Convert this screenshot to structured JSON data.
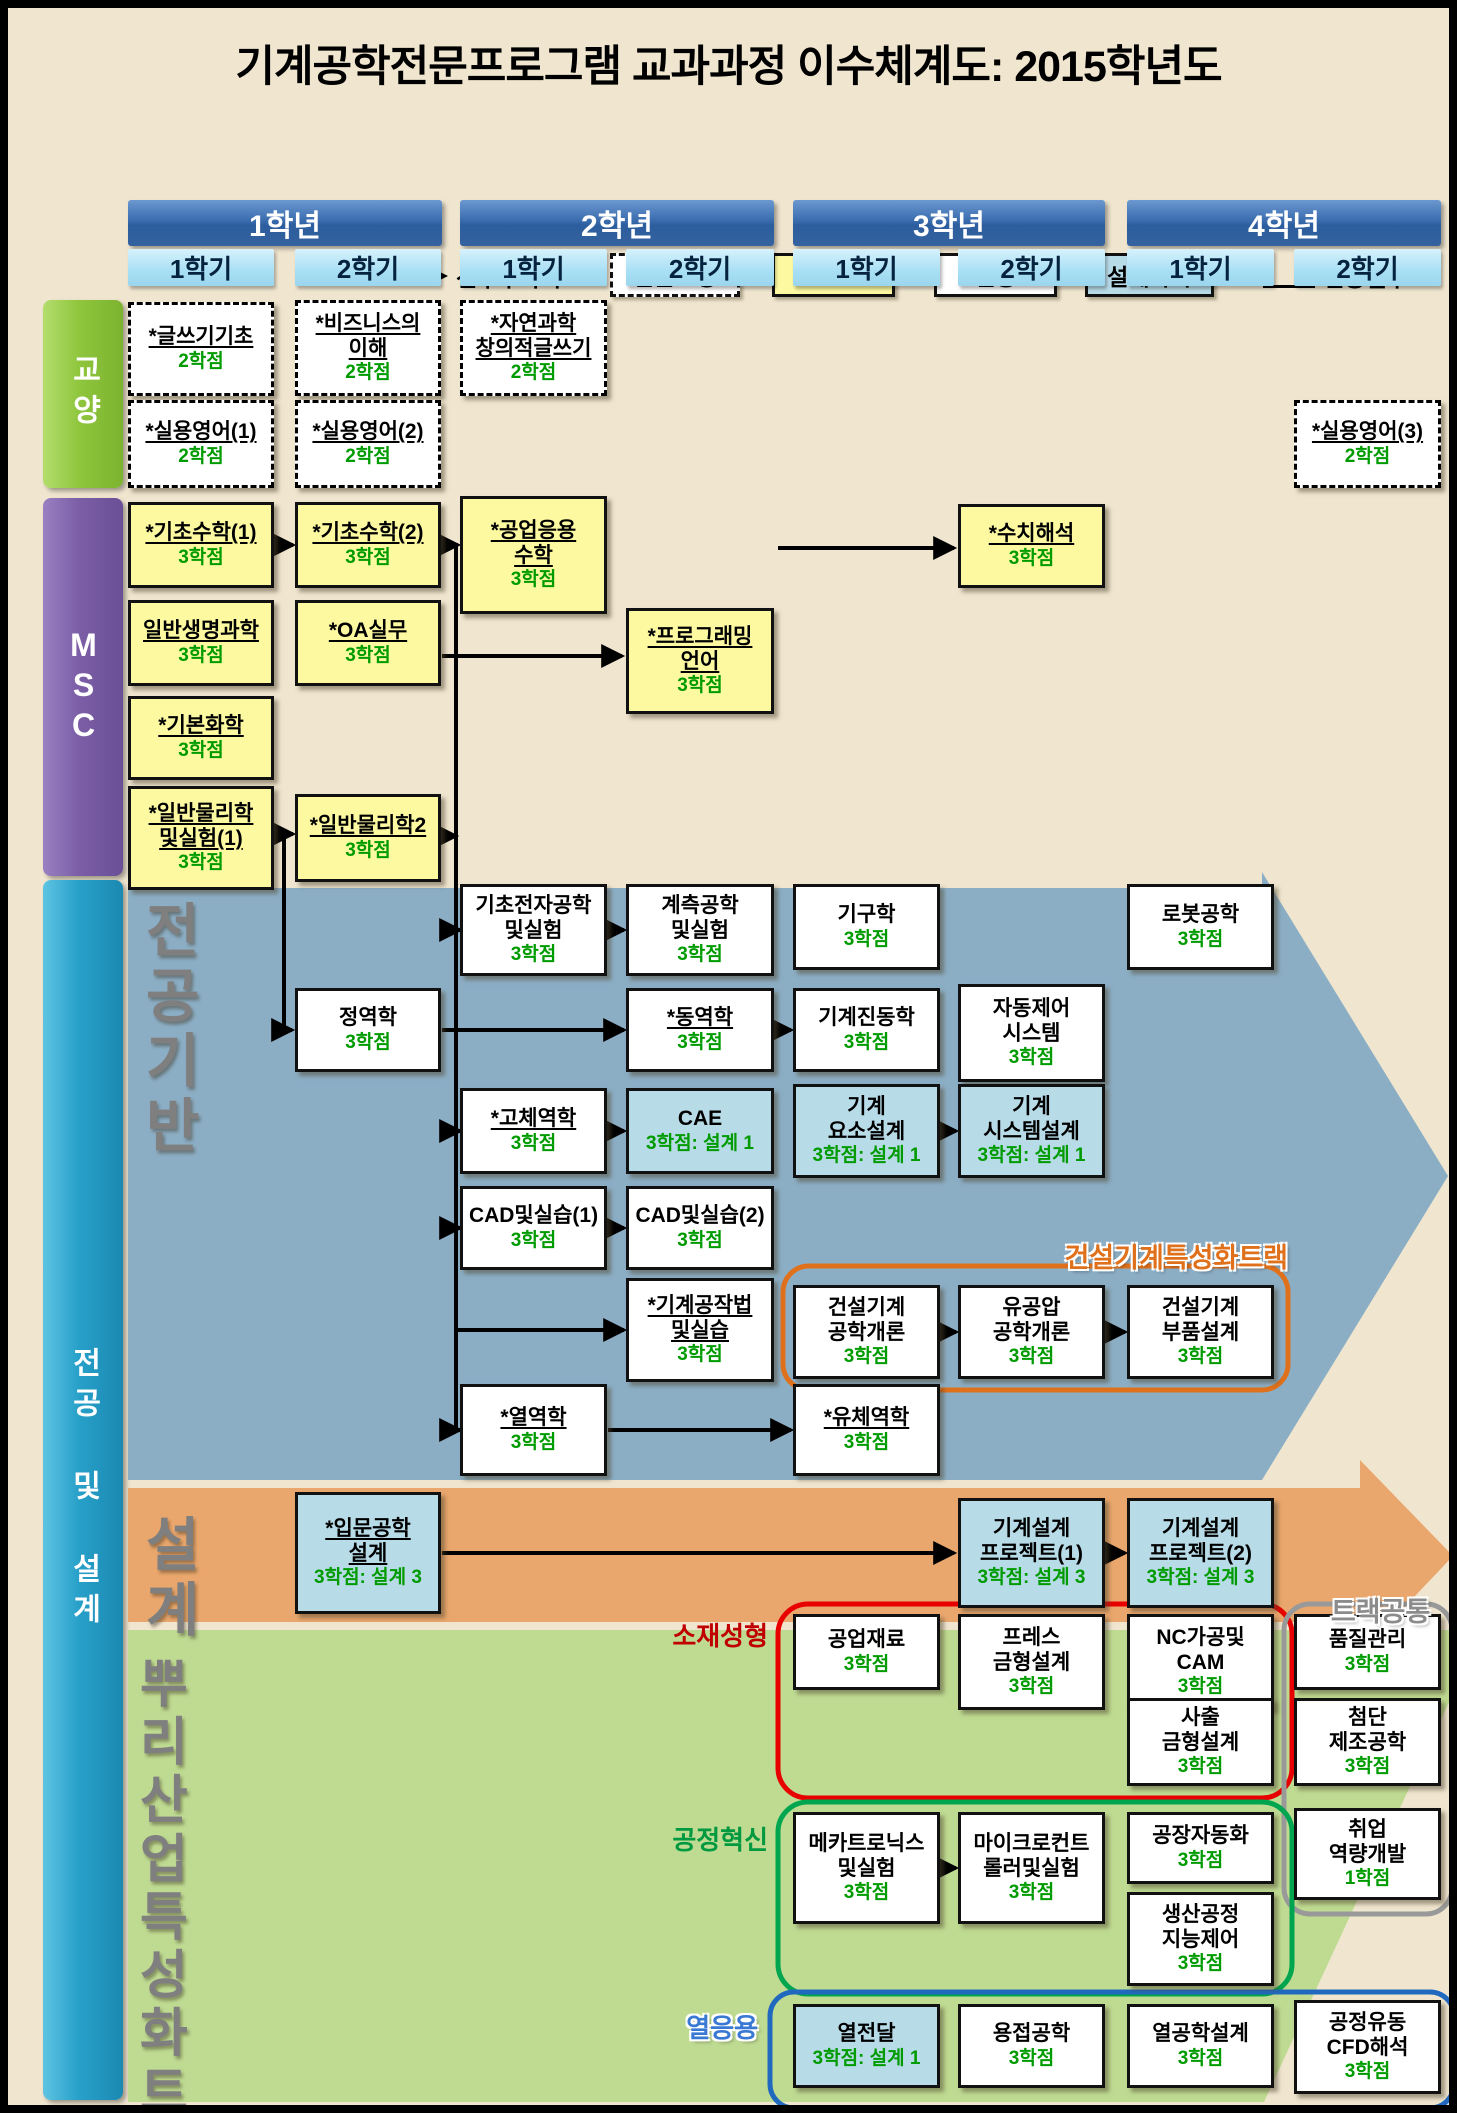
{
  "title": "기계공학전문프로그램 교과과정 이수체계도: 2015학년도",
  "legend": {
    "arrow_label": "선후수과목",
    "items": [
      {
        "label": "전문교양",
        "type": "liberal"
      },
      {
        "label": "MSC",
        "type": "msc"
      },
      {
        "label": "전공",
        "type": "major"
      },
      {
        "label": "설계과목",
        "type": "design"
      }
    ],
    "star_label": "인증필수",
    "star_symbol": "*"
  },
  "years": [
    {
      "label": "1학년",
      "semesters": [
        "1학기",
        "2학기"
      ]
    },
    {
      "label": "2학년",
      "semesters": [
        "1학기",
        "2학기"
      ]
    },
    {
      "label": "3학년",
      "semesters": [
        "1학기",
        "2학기"
      ]
    },
    {
      "label": "4학년",
      "semesters": [
        "1학기",
        "2학기"
      ]
    }
  ],
  "sidebars": [
    {
      "id": "liberal",
      "label": "교양"
    },
    {
      "id": "msc",
      "label": "MSC"
    },
    {
      "id": "majordesign",
      "label": "전공 및 설계"
    }
  ],
  "colors": {
    "background": "#F0E6D0",
    "msc_box": "#FCF9A1",
    "design_box": "#B8DBE8",
    "major_box": "#FFFFFF",
    "credit_green": "#009B00",
    "major_band": "#8CAEC5",
    "design_band": "#EAA76D",
    "roots_band": "#BFDB92",
    "sidebar_liberal": "#8FC63D",
    "sidebar_msc": "#7B5EA6",
    "sidebar_majordesign": "#27A0C9",
    "year_header": "#2F5FA0",
    "semester_header": "#A8DFF4",
    "track_construction": "#E0711C",
    "track_material": "#C00000",
    "track_process": "#009940",
    "track_thermal": "#3A79D3",
    "track_common": "#8C8C8C"
  },
  "bands": [
    {
      "name": "major-foundation-band",
      "color": "#8CAEC5",
      "points": "120,880 1254,880 1254,864 1440,1168 1254,1472 120,1472"
    },
    {
      "name": "design-band",
      "color": "#EAA76D",
      "points": "120,1480 1352,1480 1352,1452 1445,1548 1352,1646 1352,1614 120,1614"
    },
    {
      "name": "roots-band",
      "color": "#BFDB92",
      "points": "120,1622 1442,1622 1442,1692 1256,2094 120,2094"
    }
  ],
  "big_labels": [
    {
      "name": "label-major-foundation",
      "lines": [
        "전공",
        "기반"
      ],
      "x": 138,
      "y": 892,
      "size": 58
    },
    {
      "name": "label-design",
      "lines": [
        "설계"
      ],
      "x": 138,
      "y": 1506,
      "size": 58
    },
    {
      "name": "label-roots-track",
      "lines": [
        "뿌리산업",
        "특성화트랙"
      ],
      "x": 132,
      "y": 1648,
      "size": 52
    }
  ],
  "group_outlines": [
    {
      "name": "construction-track-outline",
      "x": 775,
      "y": 1258,
      "w": 505,
      "h": 124,
      "r": 26,
      "color": "#E0711C",
      "sw": 5
    },
    {
      "name": "material-forming-outline",
      "x": 770,
      "y": 1596,
      "w": 514,
      "h": 194,
      "r": 30,
      "color": "#E80000",
      "sw": 5
    },
    {
      "name": "track-common-outline",
      "x": 1276,
      "y": 1596,
      "w": 168,
      "h": 310,
      "r": 26,
      "color": "#999999",
      "sw": 5
    },
    {
      "name": "process-innovation-outline",
      "x": 770,
      "y": 1794,
      "w": 514,
      "h": 192,
      "r": 30,
      "color": "#00A64F",
      "sw": 5
    },
    {
      "name": "thermal-outline",
      "x": 762,
      "y": 1984,
      "w": 684,
      "h": 116,
      "r": 24,
      "color": "#2169BE",
      "sw": 5
    }
  ],
  "track_labels": [
    {
      "name": "label-construction-track",
      "text": "건설기계특성화트랙",
      "x": 990,
      "y": 1228,
      "w": 290,
      "size": 27,
      "color": "#E0711C",
      "align": "right",
      "glow": true
    },
    {
      "name": "label-track-common",
      "text": "트랙공통",
      "x": 1300,
      "y": 1582,
      "w": 145,
      "size": 27,
      "color": "#8C8C8C",
      "align": "center",
      "glow": true
    },
    {
      "name": "label-material-forming",
      "text": "소재성형",
      "x": 630,
      "y": 1608,
      "w": 130,
      "size": 26,
      "color": "#C00000",
      "align": "right",
      "glow": false
    },
    {
      "name": "label-process-innovation",
      "text": "공정혁신",
      "x": 630,
      "y": 1812,
      "w": 130,
      "size": 26,
      "color": "#009940",
      "align": "right",
      "glow": false
    },
    {
      "name": "label-thermal",
      "text": "열응용",
      "x": 620,
      "y": 2000,
      "w": 130,
      "size": 26,
      "color": "#3A79D3",
      "align": "right",
      "glow": true
    }
  ],
  "courses": [
    {
      "col": 1,
      "y": 294,
      "h": 94,
      "type": "liberal",
      "u": true,
      "lines": [
        "*글쓰기기초"
      ],
      "credit": "2학점"
    },
    {
      "col": 2,
      "y": 292,
      "h": 96,
      "type": "liberal",
      "u": true,
      "lines": [
        "*비즈니스의",
        "이해"
      ],
      "credit": "2학점"
    },
    {
      "col": 3,
      "y": 292,
      "h": 96,
      "type": "liberal",
      "u": true,
      "lines": [
        "*자연과학",
        "창의적글쓰기"
      ],
      "credit": "2학점"
    },
    {
      "col": 1,
      "y": 392,
      "h": 88,
      "type": "liberal",
      "u": true,
      "lines": [
        "*실용영어(1)"
      ],
      "credit": "2학점"
    },
    {
      "col": 2,
      "y": 392,
      "h": 88,
      "type": "liberal",
      "u": true,
      "lines": [
        "*실용영어(2)"
      ],
      "credit": "2학점"
    },
    {
      "col": 8,
      "y": 392,
      "h": 88,
      "type": "liberal",
      "u": true,
      "lines": [
        "*실용영어(3)"
      ],
      "credit": "2학점"
    },
    {
      "col": 1,
      "y": 494,
      "h": 86,
      "type": "msc",
      "u": true,
      "lines": [
        "*기초수학(1)"
      ],
      "credit": "3학점"
    },
    {
      "col": 2,
      "y": 494,
      "h": 86,
      "type": "msc",
      "u": true,
      "lines": [
        "*기초수학(2)"
      ],
      "credit": "3학점"
    },
    {
      "col": 3,
      "y": 488,
      "h": 118,
      "type": "msc",
      "u": true,
      "lines": [
        "*공업응용",
        "수학"
      ],
      "credit": "3학점"
    },
    {
      "col": 6,
      "y": 496,
      "h": 84,
      "type": "msc",
      "u": true,
      "lines": [
        "*수치해석"
      ],
      "credit": "3학점"
    },
    {
      "col": 1,
      "y": 592,
      "h": 86,
      "type": "msc",
      "u": true,
      "lines": [
        "일반생명과학"
      ],
      "credit": "3학점"
    },
    {
      "col": 2,
      "y": 592,
      "h": 86,
      "type": "msc",
      "u": true,
      "lines": [
        "*OA실무"
      ],
      "credit": "3학점"
    },
    {
      "col": 4,
      "y": 600,
      "h": 106,
      "type": "msc",
      "u": true,
      "lines": [
        "*프로그래밍",
        "언어"
      ],
      "credit": "3학점"
    },
    {
      "col": 1,
      "y": 688,
      "h": 84,
      "type": "msc",
      "u": true,
      "lines": [
        "*기본화학"
      ],
      "credit": "3학점"
    },
    {
      "col": 1,
      "y": 778,
      "h": 104,
      "type": "msc",
      "u": true,
      "lines": [
        "*일반물리학",
        "및실험(1)"
      ],
      "credit": "3학점"
    },
    {
      "col": 2,
      "y": 786,
      "h": 88,
      "type": "msc",
      "u": true,
      "lines": [
        "*일반물리학2"
      ],
      "credit": "3학점"
    },
    {
      "col": 3,
      "y": 876,
      "h": 92,
      "type": "major",
      "u": false,
      "lines": [
        "기초전자공학",
        "및실험"
      ],
      "credit": "3학점"
    },
    {
      "col": 4,
      "y": 876,
      "h": 92,
      "type": "major",
      "u": false,
      "lines": [
        "계측공학",
        "및실험"
      ],
      "credit": "3학점"
    },
    {
      "col": 5,
      "y": 876,
      "h": 86,
      "type": "major",
      "u": false,
      "lines": [
        "기구학"
      ],
      "credit": "3학점"
    },
    {
      "col": 7,
      "y": 876,
      "h": 86,
      "type": "major",
      "u": false,
      "lines": [
        "로봇공학"
      ],
      "credit": "3학점"
    },
    {
      "col": 2,
      "y": 980,
      "h": 84,
      "type": "major",
      "u": false,
      "lines": [
        "정역학"
      ],
      "credit": "3학점"
    },
    {
      "col": 4,
      "y": 980,
      "h": 84,
      "type": "major",
      "u": true,
      "lines": [
        "*동역학"
      ],
      "credit": "3학점"
    },
    {
      "col": 5,
      "y": 980,
      "h": 84,
      "type": "major",
      "u": false,
      "lines": [
        "기계진동학"
      ],
      "credit": "3학점"
    },
    {
      "col": 6,
      "y": 976,
      "h": 98,
      "type": "major",
      "u": false,
      "lines": [
        "자동제어",
        "시스템"
      ],
      "credit": "3학점"
    },
    {
      "col": 3,
      "y": 1080,
      "h": 86,
      "type": "major",
      "u": true,
      "lines": [
        "*고체역학"
      ],
      "credit": "3학점"
    },
    {
      "col": 4,
      "y": 1080,
      "h": 86,
      "type": "design",
      "u": false,
      "lines": [
        "CAE"
      ],
      "credit": "3학점: 설계 1"
    },
    {
      "col": 5,
      "y": 1076,
      "h": 94,
      "type": "design",
      "u": false,
      "lines": [
        "기계",
        "요소설계"
      ],
      "credit": "3학점: 설계 1"
    },
    {
      "col": 6,
      "y": 1076,
      "h": 94,
      "type": "design",
      "u": false,
      "lines": [
        "기계",
        "시스템설계"
      ],
      "credit": "3학점: 설계 1"
    },
    {
      "col": 3,
      "y": 1178,
      "h": 84,
      "type": "major",
      "u": false,
      "lines": [
        "CAD및실습(1)"
      ],
      "credit": "3학점"
    },
    {
      "col": 4,
      "y": 1178,
      "h": 84,
      "type": "major",
      "u": false,
      "lines": [
        "CAD및실습(2)"
      ],
      "credit": "3학점"
    },
    {
      "col": 4,
      "y": 1270,
      "h": 104,
      "type": "major",
      "u": true,
      "lines": [
        "*기계공작법",
        "및실습"
      ],
      "credit": "3학점"
    },
    {
      "col": 5,
      "y": 1277,
      "h": 94,
      "type": "major",
      "u": false,
      "lines": [
        "건설기계",
        "공학개론"
      ],
      "credit": "3학점"
    },
    {
      "col": 6,
      "y": 1277,
      "h": 94,
      "type": "major",
      "u": false,
      "lines": [
        "유공압",
        "공학개론"
      ],
      "credit": "3학점"
    },
    {
      "col": 7,
      "y": 1277,
      "h": 94,
      "type": "major",
      "u": false,
      "lines": [
        "건설기계",
        "부품설계"
      ],
      "credit": "3학점"
    },
    {
      "col": 3,
      "y": 1376,
      "h": 92,
      "type": "major",
      "u": true,
      "lines": [
        "*열역학"
      ],
      "credit": "3학점"
    },
    {
      "col": 5,
      "y": 1376,
      "h": 92,
      "type": "major",
      "u": true,
      "lines": [
        "*유체역학"
      ],
      "credit": "3학점"
    },
    {
      "col": 2,
      "y": 1484,
      "h": 122,
      "type": "design",
      "u": true,
      "lines": [
        "*입문공학",
        "설계"
      ],
      "credit": "3학점: 설계 3"
    },
    {
      "col": 6,
      "y": 1490,
      "h": 110,
      "type": "design",
      "u": false,
      "lines": [
        "기계설계",
        "프로젝트(1)"
      ],
      "credit": "3학점: 설계 3"
    },
    {
      "col": 7,
      "y": 1490,
      "h": 110,
      "type": "design",
      "u": false,
      "lines": [
        "기계설계",
        "프로젝트(2)"
      ],
      "credit": "3학점: 설계 3"
    },
    {
      "col": 5,
      "y": 1606,
      "h": 76,
      "type": "major",
      "u": false,
      "lines": [
        "공업재료"
      ],
      "credit": "3학점"
    },
    {
      "col": 6,
      "y": 1606,
      "h": 96,
      "type": "major",
      "u": false,
      "lines": [
        "프레스",
        "금형설계"
      ],
      "credit": "3학점"
    },
    {
      "col": 7,
      "y": 1606,
      "h": 96,
      "type": "major",
      "u": false,
      "lines": [
        "NC가공및",
        "CAM"
      ],
      "credit": "3학점"
    },
    {
      "col": 8,
      "y": 1606,
      "h": 76,
      "type": "major",
      "u": false,
      "lines": [
        "품질관리"
      ],
      "credit": "3학점"
    },
    {
      "col": 7,
      "y": 1690,
      "h": 88,
      "type": "major",
      "u": false,
      "lines": [
        "사출",
        "금형설계"
      ],
      "credit": "3학점"
    },
    {
      "col": 8,
      "y": 1690,
      "h": 88,
      "type": "major",
      "u": false,
      "lines": [
        "첨단",
        "제조공학"
      ],
      "credit": "3학점"
    },
    {
      "col": 5,
      "y": 1804,
      "h": 112,
      "type": "major",
      "u": false,
      "lines": [
        "메카트로닉스",
        "및실험"
      ],
      "credit": "3학점"
    },
    {
      "col": 6,
      "y": 1804,
      "h": 112,
      "type": "major",
      "u": false,
      "lines": [
        "마이크로컨트",
        "롤러및실험"
      ],
      "credit": "3학점"
    },
    {
      "col": 7,
      "y": 1804,
      "h": 72,
      "type": "major",
      "u": false,
      "lines": [
        "공장자동화"
      ],
      "credit": "3학점"
    },
    {
      "col": 8,
      "y": 1800,
      "h": 92,
      "type": "major",
      "u": false,
      "lines": [
        "취업",
        "역량개발"
      ],
      "credit": "1학점"
    },
    {
      "col": 7,
      "y": 1884,
      "h": 94,
      "type": "major",
      "u": false,
      "lines": [
        "생산공정",
        "지능제어"
      ],
      "credit": "3학점"
    },
    {
      "col": 5,
      "y": 1996,
      "h": 84,
      "type": "design",
      "u": false,
      "lines": [
        "열전달"
      ],
      "credit": "3학점: 설계 1"
    },
    {
      "col": 6,
      "y": 1996,
      "h": 84,
      "type": "major",
      "u": false,
      "lines": [
        "용접공학"
      ],
      "credit": "3학점"
    },
    {
      "col": 7,
      "y": 1996,
      "h": 84,
      "type": "major",
      "u": false,
      "lines": [
        "열공학설계"
      ],
      "credit": "3학점"
    },
    {
      "col": 8,
      "y": 1992,
      "h": 94,
      "type": "major",
      "u": false,
      "lines": [
        "공정유동",
        "CFD해석"
      ],
      "credit": "3학점"
    }
  ],
  "arrows": [
    {
      "points": [
        [
          267,
          537
        ],
        [
          285,
          537
        ]
      ],
      "head": true
    },
    {
      "points": [
        [
          434,
          537
        ],
        [
          450,
          537
        ]
      ],
      "head": true
    },
    {
      "points": [
        [
          770,
          540
        ],
        [
          946,
          540
        ]
      ],
      "head": true
    },
    {
      "points": [
        [
          434,
          648
        ],
        [
          614,
          648
        ]
      ],
      "head": true
    },
    {
      "points": [
        [
          267,
          826
        ],
        [
          285,
          826
        ]
      ],
      "head": true
    },
    {
      "points": [
        [
          434,
          828
        ],
        [
          448,
          828
        ]
      ],
      "head": true
    },
    {
      "points": [
        [
          276,
          826
        ],
        [
          276,
          1022
        ],
        [
          284,
          1022
        ]
      ],
      "head": true
    },
    {
      "points": [
        [
          448,
          537
        ],
        [
          448,
          1422
        ]
      ],
      "head": false
    },
    {
      "points": [
        [
          440,
          922
        ],
        [
          452,
          922
        ]
      ],
      "head": true
    },
    {
      "points": [
        [
          440,
          1123
        ],
        [
          452,
          1123
        ]
      ],
      "head": true
    },
    {
      "points": [
        [
          440,
          1220
        ],
        [
          452,
          1220
        ]
      ],
      "head": true
    },
    {
      "points": [
        [
          448,
          1322
        ],
        [
          616,
          1322
        ]
      ],
      "head": true
    },
    {
      "points": [
        [
          440,
          1422
        ],
        [
          452,
          1422
        ]
      ],
      "head": true
    },
    {
      "points": [
        [
          600,
          922
        ],
        [
          616,
          922
        ]
      ],
      "head": true
    },
    {
      "points": [
        [
          434,
          1022
        ],
        [
          616,
          1022
        ]
      ],
      "head": true
    },
    {
      "points": [
        [
          767,
          1022
        ],
        [
          783,
          1022
        ]
      ],
      "head": true
    },
    {
      "points": [
        [
          600,
          1123
        ],
        [
          616,
          1123
        ]
      ],
      "head": true
    },
    {
      "points": [
        [
          933,
          1123
        ],
        [
          948,
          1123
        ]
      ],
      "head": true
    },
    {
      "points": [
        [
          600,
          1220
        ],
        [
          616,
          1220
        ]
      ],
      "head": true
    },
    {
      "points": [
        [
          933,
          1324
        ],
        [
          948,
          1324
        ]
      ],
      "head": true
    },
    {
      "points": [
        [
          1098,
          1324
        ],
        [
          1117,
          1324
        ]
      ],
      "head": true
    },
    {
      "points": [
        [
          600,
          1422
        ],
        [
          783,
          1422
        ]
      ],
      "head": true
    },
    {
      "points": [
        [
          434,
          1545
        ],
        [
          946,
          1545
        ]
      ],
      "head": true
    },
    {
      "points": [
        [
          1098,
          1545
        ],
        [
          1117,
          1545
        ]
      ],
      "head": true
    },
    {
      "points": [
        [
          933,
          1860
        ],
        [
          948,
          1860
        ]
      ],
      "head": true
    }
  ]
}
